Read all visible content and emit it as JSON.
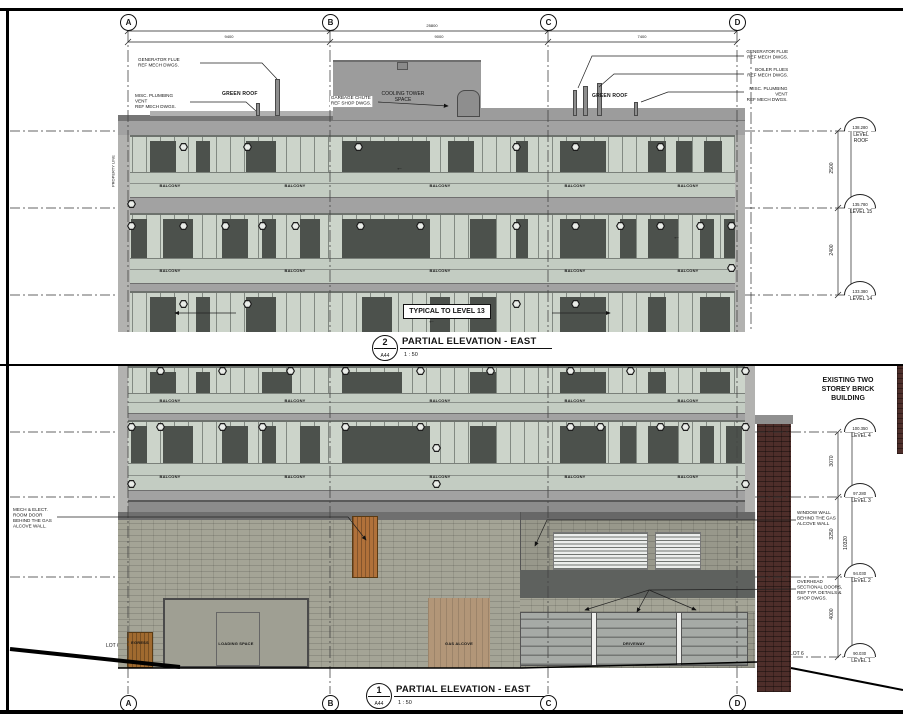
{
  "sheet": {
    "grid_columns": [
      "A",
      "B",
      "C",
      "D"
    ],
    "property_line_label": "PROPERTY LINE",
    "colors": {
      "glazing": "#ccd4ca",
      "balcony": "#c3ccc2",
      "slab": "#a2a2a2",
      "dark_panel": "#4c514c",
      "concrete_block": "#a4a496",
      "brick": "#4e2e2a",
      "wood_door": "#a06a2f",
      "gas_panel": "#b29678",
      "overhead_door": "#a6aaa6"
    }
  },
  "panel2": {
    "dim_overall": "25800",
    "dims": [
      "9400",
      "9000",
      "7400"
    ],
    "ann_generator_flue_left": "GENERATOR FLUE\nREF MECH DWGS.",
    "ann_plumbing_vent_left": "MISC. PLUMBING\nVENT\nREF MECH DWGS.",
    "green_roof_left": "GREEN ROOF",
    "cooling_tower": "COOLING TOWER\nSPACE",
    "garbage_chute": "GARBAGE CHUTE\nREF SHOP DWGS.",
    "ann_generator_flue_right": "GENERATOR FLUE\nREF MECH DWGS.",
    "ann_boiler_flues": "BOILER FLUES\nREF MECH DWGS.",
    "ann_plumbing_vent_right": "MISC. PLUMBING VENT\nREF MECH DWGS.",
    "green_roof_right": "GREEN ROOF",
    "balcony_label": "BALCONY",
    "typical_note": "TYPICAL TO LEVEL 13",
    "levels": [
      {
        "elev": "138.280",
        "label": "LEVEL\nROOF"
      },
      {
        "elev": "135.780",
        "label": "LEVEL 15"
      },
      {
        "elev": "133.380",
        "label": "LEVEL 14"
      }
    ],
    "dims_right": [
      "2500",
      "2400"
    ],
    "title": {
      "num": "2",
      "sheet": "A44",
      "text": "PARTIAL ELEVATION - EAST",
      "scale": "1 : 50"
    }
  },
  "panel1": {
    "existing_building": "EXISTING TWO\nSTOREY BRICK\nBUILDING",
    "ann_mech_room": "MECH & ELECT.\nROOM DOOR\nBEHIND THE GAS\nALCOVE WALL.",
    "ann_window_wall": "WINDOW WALL\nBEHIND THE GAS\nALCOVE WALL",
    "ann_overhead_doors": "OVERHEAD\nSECTIONAL DOORS,\nREF TYP. DETAILS &\nSHOP DWGS.",
    "label_egress": "EGRESS",
    "label_loading": "LOADING SPACE",
    "label_gas_alcove": "GAS ALCOVE",
    "label_driveway": "DRIVEWAY",
    "label_lot_left": "LOT 6",
    "label_lot_right": "LOT 6",
    "balcony_label": "BALCONY",
    "levels": [
      {
        "elev": "100.350",
        "label": "LEVEL 4"
      },
      {
        "elev": "97.280",
        "label": "LEVEL 3"
      },
      {
        "elev": "94.030",
        "label": "LEVEL 2"
      },
      {
        "elev": "90.030",
        "label": "LEVEL 1"
      }
    ],
    "dims_right": [
      "3070",
      "3250",
      "4000"
    ],
    "dim_total": "10320",
    "title": {
      "num": "1",
      "sheet": "A44",
      "text": "PARTIAL ELEVATION - EAST",
      "scale": "1 : 50"
    }
  }
}
